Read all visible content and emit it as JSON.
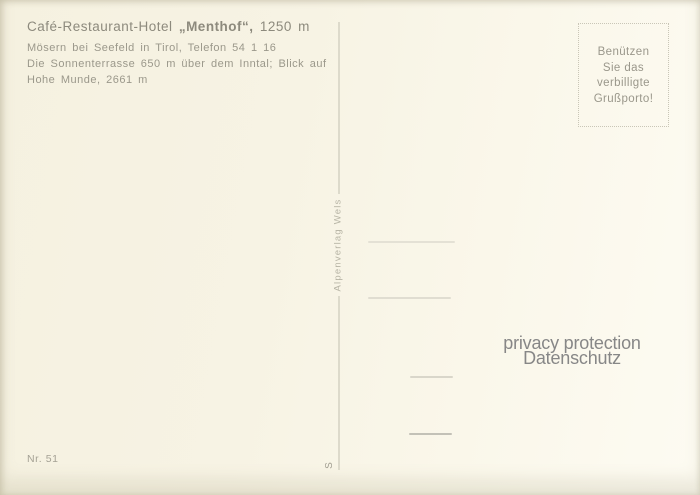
{
  "postcard": {
    "header": {
      "title_prefix": "Café-Restaurant-Hotel ",
      "title_name": "„Menthof“,",
      "title_suffix": " 1250 m",
      "address_line": "Mösern bei Seefeld in Tirol, Telefon 54 1 16",
      "description_line1": "Die Sonnenterrasse 650 m über dem Inntal; Blick auf",
      "description_line2": "Hohe Munde, 2661 m"
    },
    "stamp_box": {
      "lines": [
        "Benützen",
        "Sie das",
        "verbilligte",
        "Grußporto!"
      ]
    },
    "publisher": "Alpenverlag Wels",
    "publisher_mark": "S",
    "card_number": "Nr. 51",
    "watermark": {
      "line1": "privacy protection",
      "line2": "Datenschutz"
    },
    "colors": {
      "card_background": "#f7f3e4",
      "card_background_light": "#fdfbf2",
      "ink": "#98958a",
      "ink_dark": "#8d8a7d",
      "divider": "#dddacb",
      "stamp_border": "#c9c6b7",
      "watermark_gray": "#878787"
    }
  }
}
